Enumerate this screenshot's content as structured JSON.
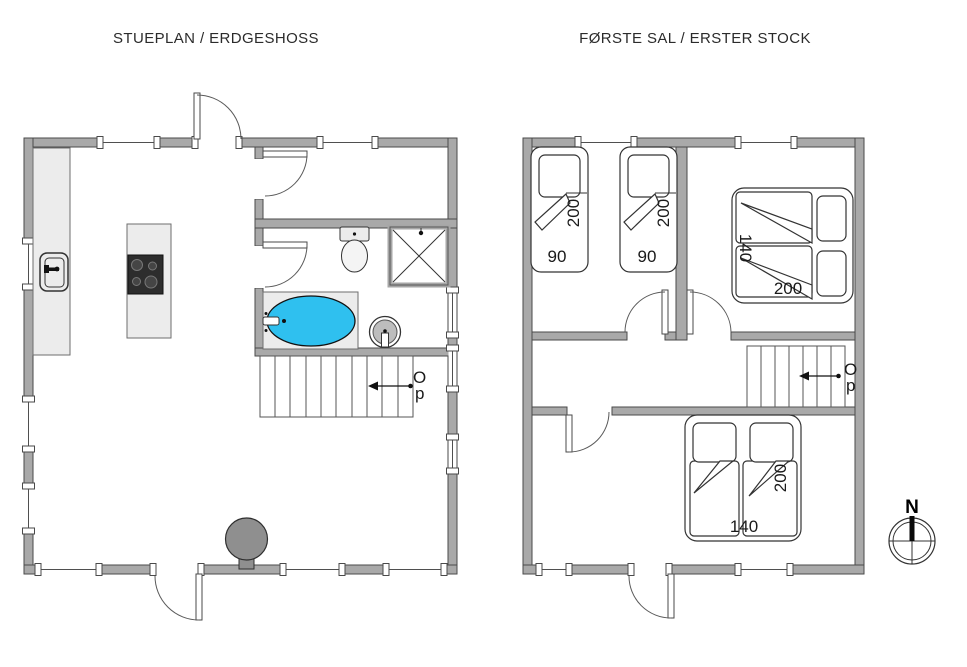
{
  "ground_floor": {
    "title": "STUEPLAN / ERDGESHOSS",
    "stairs": {
      "label_line1": "O",
      "label_line2": "p"
    }
  },
  "first_floor": {
    "title": "FØRSTE SAL / ERSTER STOCK",
    "stairs": {
      "label_line1": "O",
      "label_line2": "p"
    },
    "beds": {
      "single_left": {
        "length_cm": "200",
        "width_cm": "90"
      },
      "single_right": {
        "length_cm": "200",
        "width_cm": "90"
      },
      "double_top": {
        "width_cm": "140",
        "length_cm": "200"
      },
      "double_bottom": {
        "width_cm": "140",
        "length_cm": "200"
      }
    }
  },
  "compass": {
    "north_label": "N"
  },
  "colors": {
    "wall": "#a9a9a9",
    "wall_outline": "#4a4a4a",
    "bathtub_fill": "#2fc0ef",
    "furniture_light": "#ececec",
    "stove_fill": "#8f8f8f",
    "cooktop_fill": "#2d2d2d"
  }
}
